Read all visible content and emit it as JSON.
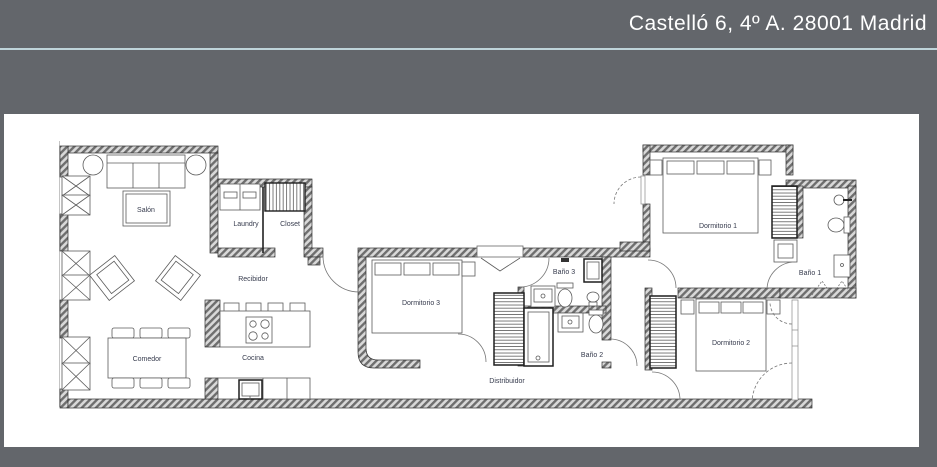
{
  "header": {
    "title": "Castelló 6, 4º A. 28001 Madrid"
  },
  "colors": {
    "header_bg": "#63666b",
    "divider_line": "#bfd4da",
    "panel_bg": "#ffffff",
    "wall_hatch_dark": "#6e6e6e",
    "wall_hatch_light": "#d9d9d9",
    "label_text": "#363b4d",
    "title_text": "#ffffff"
  },
  "floorplan": {
    "rooms": [
      {
        "label": "Salón"
      },
      {
        "label": "Laundry"
      },
      {
        "label": "Closet"
      },
      {
        "label": "Recibidor"
      },
      {
        "label": "Comedor"
      },
      {
        "label": "Cocina"
      },
      {
        "label": "Dormitorio 3"
      },
      {
        "label": "Baño 3"
      },
      {
        "label": "Baño 2"
      },
      {
        "label": "Distribuidor"
      },
      {
        "label": "Dormitorio 1"
      },
      {
        "label": "Baño 1"
      },
      {
        "label": "Dormitorio 2"
      }
    ]
  }
}
